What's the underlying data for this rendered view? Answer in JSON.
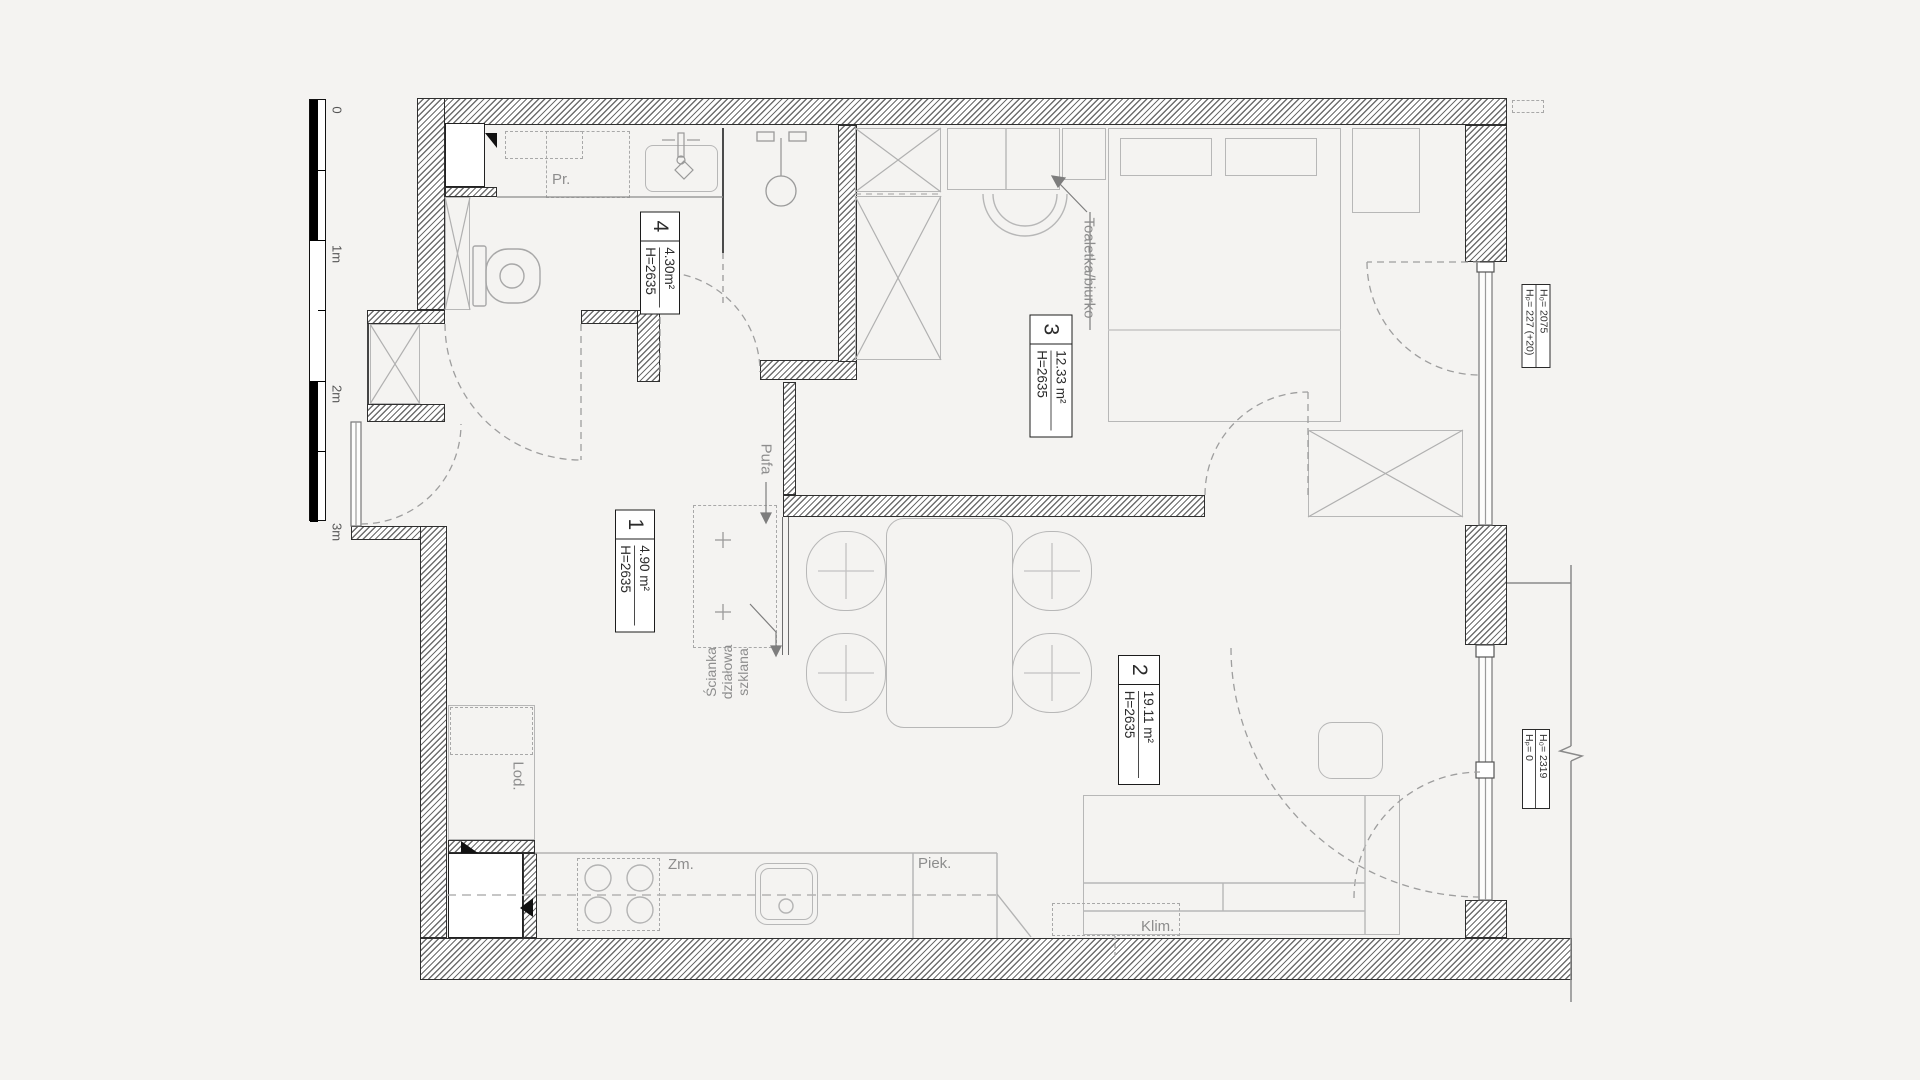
{
  "scale_bar": {
    "labels": [
      "0",
      "1m",
      "2m",
      "3m"
    ]
  },
  "rooms": [
    {
      "num": "4",
      "area": "4.30m²",
      "height": "H=2635"
    },
    {
      "num": "3",
      "area": "12.33 m²",
      "height": "H=2635"
    },
    {
      "num": "1",
      "area": "4.90 m²",
      "height": "H=2635"
    },
    {
      "num": "2",
      "area": "19.11 m²",
      "height": "H=2635"
    }
  ],
  "window_labels": [
    {
      "line1": "H₀= 2075",
      "line2": "Hₚ= 227 (+20)"
    },
    {
      "line1": "H₀= 2319",
      "line2": "Hₚ= 0"
    }
  ],
  "annotations": {
    "washer": "Pr.",
    "fridge": "Lod.",
    "dishwasher": "Zm.",
    "oven": "Piek.",
    "air_conditioner": "Klim.",
    "pouf": "Pufa",
    "vanity_desk": "Toaletka/biurko",
    "glass_wall": [
      "Ścianka",
      "działowa",
      "szklana"
    ]
  }
}
